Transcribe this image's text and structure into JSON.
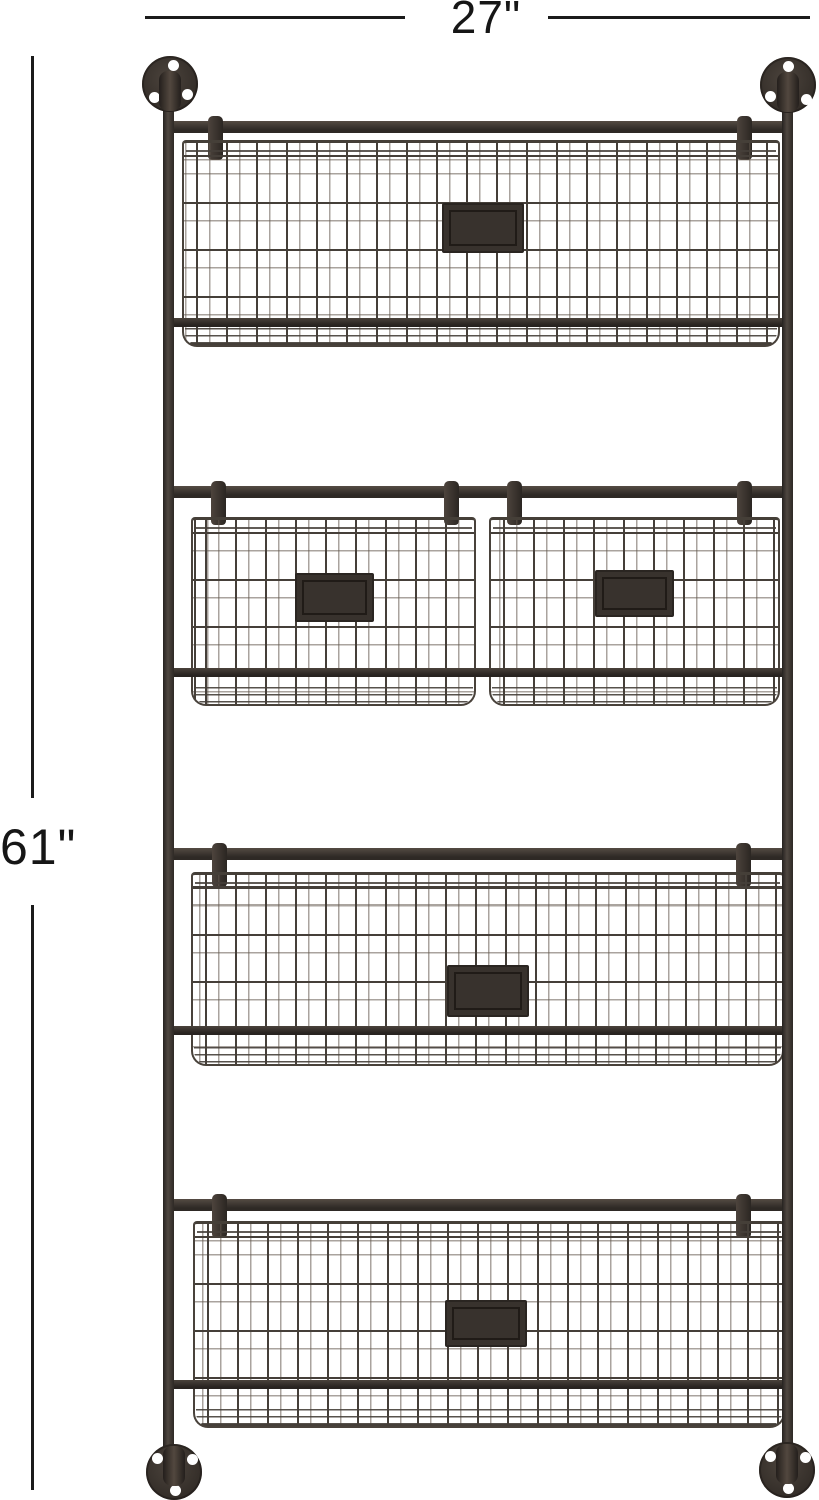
{
  "annotations": {
    "width_label": "27\"",
    "height_label": "61\""
  },
  "product": {
    "description": "black metal wall-mounted wire basket organizer",
    "rows": [
      {
        "row": 1,
        "baskets": 1,
        "label_plates": 1
      },
      {
        "row": 2,
        "baskets": 2,
        "label_plates": 2
      },
      {
        "row": 3,
        "baskets": 1,
        "label_plates": 1
      },
      {
        "row": 4,
        "baskets": 1,
        "label_plates": 1
      }
    ],
    "mount_flanges": 4
  },
  "colors": {
    "background": "#ffffff",
    "frame": "#38322d",
    "wire": "#453f39",
    "label_plate": "#332d28",
    "annotation": "#1b1b1b"
  }
}
